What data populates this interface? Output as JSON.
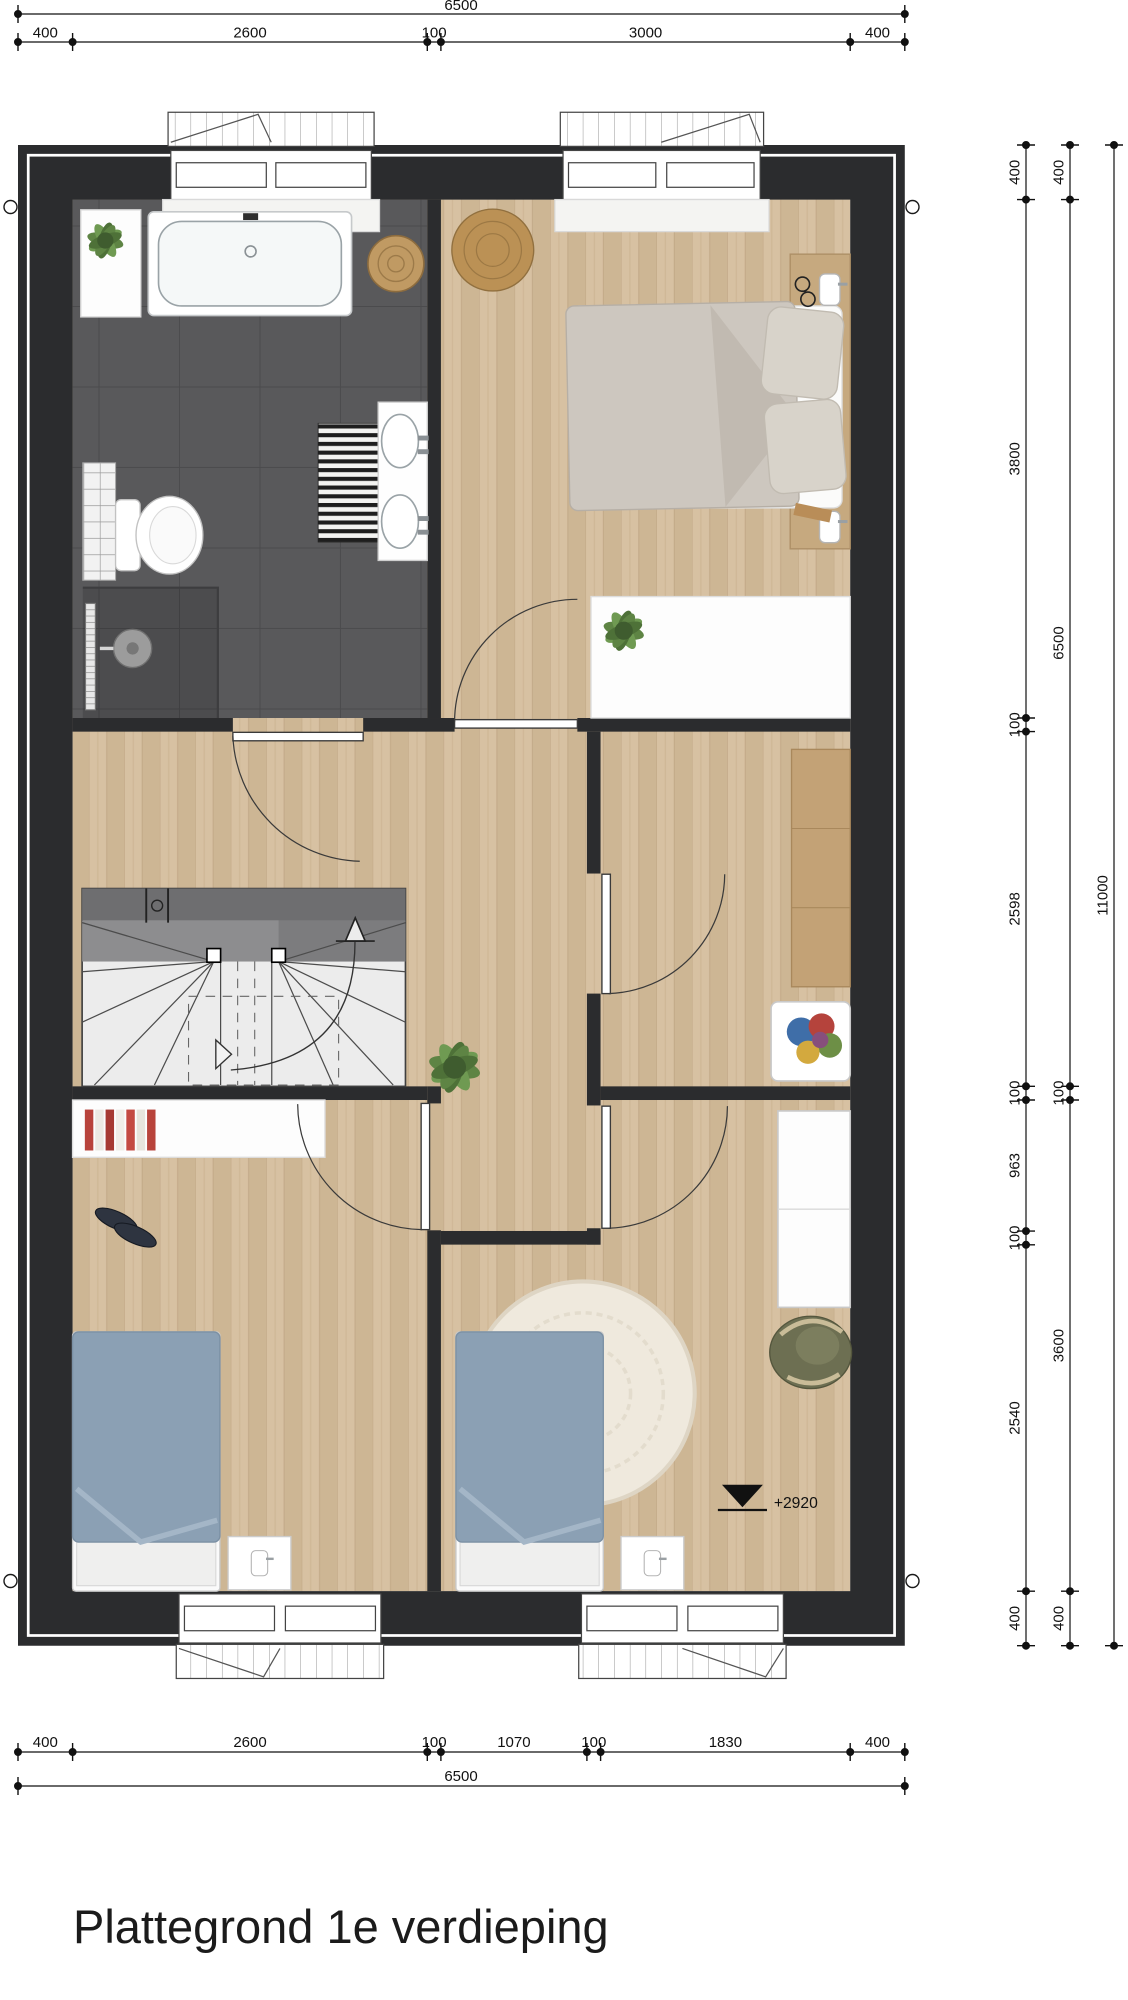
{
  "title": "Plattegrond 1e verdieping",
  "elevation_marker": "+2920",
  "dims": {
    "top": {
      "overall": "6500",
      "segments": [
        "400",
        "2600",
        "100",
        "3000",
        "400"
      ]
    },
    "bottom": {
      "overall": "6500",
      "segments": [
        "400",
        "2600",
        "100",
        "1070",
        "100",
        "1830",
        "400"
      ]
    },
    "right": {
      "outer": "11000",
      "middle": [
        "400",
        "6500",
        "100",
        "3600",
        "400"
      ],
      "inner": [
        "400",
        "3800",
        "100",
        "2598",
        "100",
        "963",
        "100",
        "2540",
        "400"
      ]
    }
  },
  "colors": {
    "wall": "#2b2c2e",
    "wood_floor": "#d7c1a2",
    "tile_floor": "#59595b",
    "kids_duvet": "#8ba0b4",
    "master_duvet": "#cdc7bf"
  }
}
